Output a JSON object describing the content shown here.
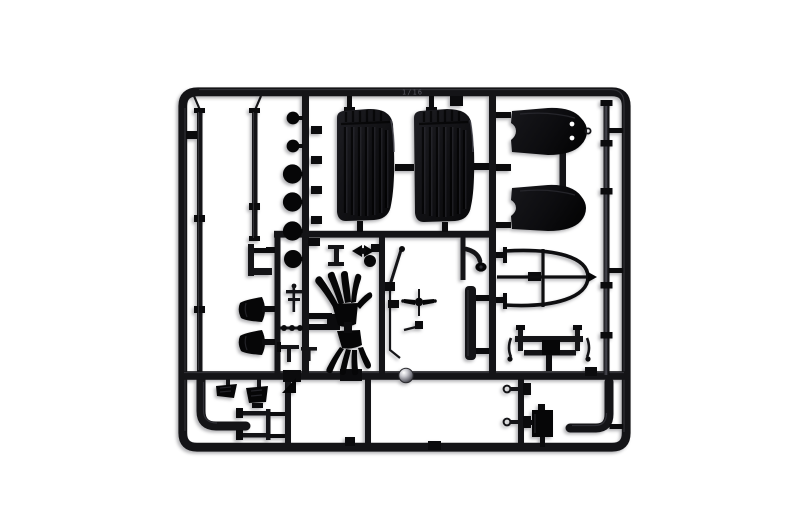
{
  "scene": {
    "type": "studio product photograph",
    "subject": "black injection-molded plastic model kit sprue (parts tree) for a 1/16 scale classic car interior set",
    "background": "plain white seamless backdrop",
    "frame_marking": "1/16"
  },
  "colors": {
    "plastic": "#141417",
    "plastic-dark": "#0b0b0d",
    "plastic-deep": "#060607",
    "highlight": "#55555e",
    "background": "#ffffff",
    "gate-metal": "#c9c9cf"
  },
  "parts": [
    {
      "name": "sprue-frame",
      "qty": 1,
      "zone": "outer border",
      "desc": "rounded rectangular runner frame with internal runner grid"
    },
    {
      "name": "seat-cushion",
      "qty": 2,
      "zone": "top center",
      "desc": "ribbed bucket-seat back panels"
    },
    {
      "name": "seat-back-panel",
      "qty": 2,
      "zone": "top right",
      "desc": "round-ended backrest boards, upper one with two locating holes"
    },
    {
      "name": "chassis-rail-rod",
      "qty": 2,
      "zone": "upper left",
      "desc": "long thin rails with mounting tabs"
    },
    {
      "name": "round-disc",
      "qty": 6,
      "zone": "left column",
      "desc": "stacked circular hubs/caps on vertical runner"
    },
    {
      "name": "horn-cone",
      "qty": 2,
      "zone": "mid left",
      "desc": "cone shaped bells"
    },
    {
      "name": "exhaust-header-cluster",
      "qty": 2,
      "zone": "center",
      "desc": "fanned glove-like pipe bundles"
    },
    {
      "name": "gear-lever-linkage",
      "qty": 3,
      "zone": "center right",
      "desc": "thin shift/brake levers with knobs"
    },
    {
      "name": "propeller-fan",
      "qty": 1,
      "zone": "center",
      "desc": "two-blade fan with hub"
    },
    {
      "name": "windscreen-frame",
      "qty": 1,
      "zone": "right",
      "desc": "D-shaped hoop with cross bars"
    },
    {
      "name": "suspension-subframe",
      "qty": 1,
      "zone": "right",
      "desc": "small frame with corner posts"
    },
    {
      "name": "running-board-strip",
      "qty": 1,
      "zone": "center right",
      "desc": "long flat strip"
    },
    {
      "name": "steering-column-rod",
      "qty": 1,
      "zone": "far right",
      "desc": "long banded rod"
    },
    {
      "name": "exhaust-elbow-pipe",
      "qty": 2,
      "zone": "bottom",
      "desc": "thick L-bent pipes"
    },
    {
      "name": "pedal",
      "qty": 2,
      "zone": "bottom left",
      "desc": "pedal pads on stems"
    },
    {
      "name": "battery-box",
      "qty": 1,
      "zone": "bottom right",
      "desc": "small rectangular box"
    },
    {
      "name": "tie-rod-pin",
      "qty": 2,
      "zone": "bottom right",
      "desc": "pins with eye rings"
    },
    {
      "name": "bracket-frame",
      "qty": 1,
      "zone": "bottom left",
      "desc": "open rectangular bracket"
    },
    {
      "name": "injection-gate-ball",
      "qty": 1,
      "zone": "center runner",
      "desc": "shiny molding gate sphere"
    },
    {
      "name": "part-number-tab",
      "qty": 12,
      "zone": "on runners",
      "desc": "small embossed number tabs"
    }
  ]
}
